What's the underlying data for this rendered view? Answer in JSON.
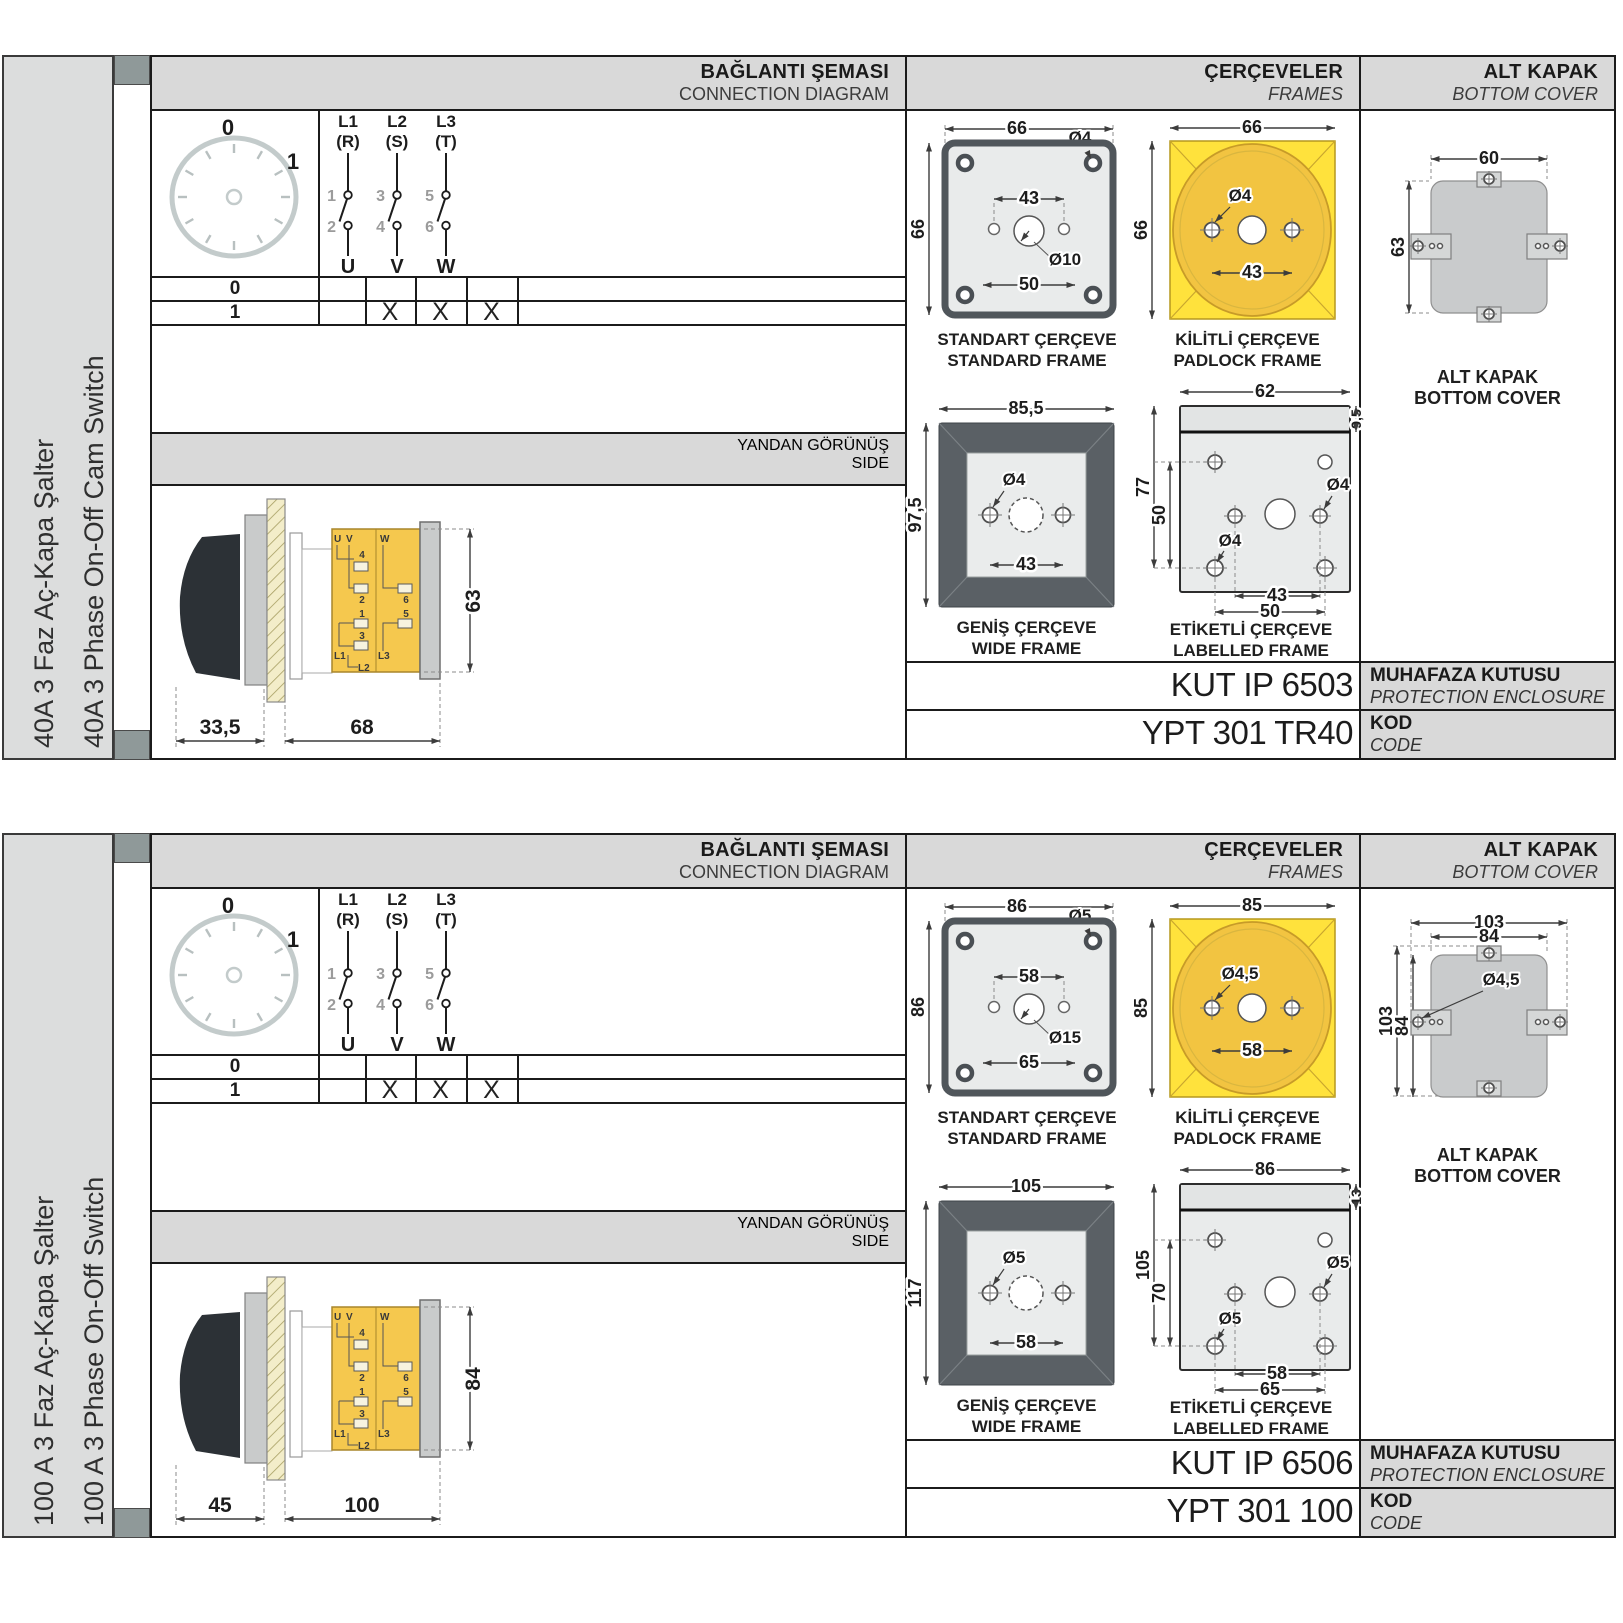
{
  "sections": [
    {
      "sidebar": {
        "label_tr": "40A 3 Faz Aç-Kapa Şalter",
        "label_en": "40A 3 Phase On-Off Cam Switch"
      },
      "headers": {
        "connection_tr": "BAĞLANTI ŞEMASI",
        "connection_en": "CONNECTION DIAGRAM",
        "frames_tr": "ÇERÇEVELER",
        "frames_en": "FRAMES",
        "cover_tr": "ALT KAPAK",
        "cover_en": "BOTTOM COVER",
        "side_tr": "YANDAN GÖRÜNÜŞ",
        "side_en": "SIDE"
      },
      "dial": {
        "pos0": "0",
        "pos1": "1"
      },
      "phases": [
        {
          "name": "L1",
          "alt": "(R)",
          "t1": "1",
          "t2": "2",
          "out": "U"
        },
        {
          "name": "L2",
          "alt": "(S)",
          "t1": "3",
          "t2": "4",
          "out": "V"
        },
        {
          "name": "L3",
          "alt": "(T)",
          "t1": "5",
          "t2": "6",
          "out": "W"
        }
      ],
      "table": {
        "r0": {
          "pos": "0",
          "m1": "",
          "m2": "",
          "m3": ""
        },
        "r1": {
          "pos": "1",
          "m1": "X",
          "m2": "X",
          "m3": "X"
        }
      },
      "side_view": {
        "dim_front": "33,5",
        "dim_body": "68",
        "dim_height": "63",
        "t": {
          "u": "U",
          "v": "V",
          "w": "W",
          "n1": "1",
          "n2": "2",
          "n3": "3",
          "n4": "4",
          "n5": "5",
          "n6": "6",
          "l1": "L1",
          "l2": "L2",
          "l3": "L3"
        }
      },
      "frames": {
        "standard": {
          "title_tr": "STANDART ÇERÇEVE",
          "title_en": "STANDARD FRAME",
          "dim_w": "66",
          "dim_h": "66",
          "dim_holes": "43",
          "dim_outer": "50",
          "dia_corner": "Ø4",
          "dia_center": "Ø10"
        },
        "padlock": {
          "title_tr": "KİLİTLİ ÇERÇEVE",
          "title_en": "PADLOCK FRAME",
          "dim_w": "66",
          "dim_h": "66",
          "dim_holes": "43",
          "dia": "Ø4"
        },
        "wide": {
          "title_tr": "GENİŞ ÇERÇEVE",
          "title_en": "WIDE FRAME",
          "dim_w": "85,5",
          "dim_h": "97,5",
          "dim_holes": "43",
          "dia": "Ø4"
        },
        "labelled": {
          "title_tr": "ETİKETLİ ÇERÇEVE",
          "title_en": "LABELLED FRAME",
          "dim_w": "62",
          "dim_strip": "9,5",
          "dim_h": "77",
          "dim_holes_v": "50",
          "dim_holes": "43",
          "dim_outer": "50",
          "dia1": "Ø4",
          "dia2": "Ø4"
        }
      },
      "cover": {
        "title_tr": "ALT KAPAK",
        "title_en": "BOTTOM COVER",
        "dim_w": "60",
        "dim_h": "63"
      },
      "enclosure": {
        "value": "KUT IP 6503",
        "label_tr": "MUHAFAZA KUTUSU",
        "label_en": "PROTECTION ENCLOSURE"
      },
      "kod": {
        "value": "YPT 301 TR40",
        "label_tr": "KOD",
        "label_en": "CODE"
      }
    },
    {
      "sidebar": {
        "label_tr": "100 A 3 Faz Aç-Kapa Şalter",
        "label_en": "100 A 3 Phase On-Off Switch"
      },
      "headers": {
        "connection_tr": "BAĞLANTI ŞEMASI",
        "connection_en": "CONNECTION DIAGRAM",
        "frames_tr": "ÇERÇEVELER",
        "frames_en": "FRAMES",
        "cover_tr": "ALT KAPAK",
        "cover_en": "BOTTOM COVER",
        "side_tr": "YANDAN GÖRÜNÜŞ",
        "side_en": "SIDE"
      },
      "dial": {
        "pos0": "0",
        "pos1": "1"
      },
      "phases": [
        {
          "name": "L1",
          "alt": "(R)",
          "t1": "1",
          "t2": "2",
          "out": "U"
        },
        {
          "name": "L2",
          "alt": "(S)",
          "t1": "3",
          "t2": "4",
          "out": "V"
        },
        {
          "name": "L3",
          "alt": "(T)",
          "t1": "5",
          "t2": "6",
          "out": "W"
        }
      ],
      "table": {
        "r0": {
          "pos": "0",
          "m1": "",
          "m2": "",
          "m3": ""
        },
        "r1": {
          "pos": "1",
          "m1": "X",
          "m2": "X",
          "m3": "X"
        }
      },
      "side_view": {
        "dim_front": "45",
        "dim_body": "100",
        "dim_height": "84",
        "t": {
          "u": "U",
          "v": "V",
          "w": "W",
          "n1": "1",
          "n2": "2",
          "n3": "3",
          "n4": "4",
          "n5": "5",
          "n6": "6",
          "l1": "L1",
          "l2": "L2",
          "l3": "L3"
        }
      },
      "frames": {
        "standard": {
          "title_tr": "STANDART ÇERÇEVE",
          "title_en": "STANDARD FRAME",
          "dim_w": "86",
          "dim_h": "86",
          "dim_holes": "58",
          "dim_outer": "65",
          "dia_corner": "Ø5",
          "dia_center": "Ø15"
        },
        "padlock": {
          "title_tr": "KİLİTLİ ÇERÇEVE",
          "title_en": "PADLOCK FRAME",
          "dim_w": "85",
          "dim_h": "85",
          "dim_holes": "58",
          "dia": "Ø4,5"
        },
        "wide": {
          "title_tr": "GENİŞ ÇERÇEVE",
          "title_en": "WIDE FRAME",
          "dim_w": "105",
          "dim_h": "117",
          "dim_holes": "58",
          "dia": "Ø5"
        },
        "labelled": {
          "title_tr": "ETİKETLİ ÇERÇEVE",
          "title_en": "LABELLED FRAME",
          "dim_w": "86",
          "dim_strip": "13",
          "dim_h": "105",
          "dim_holes_v": "70",
          "dim_holes": "58",
          "dim_outer": "65",
          "dia1": "Ø5",
          "dia2": "Ø5"
        }
      },
      "cover": {
        "title_tr": "ALT KAPAK",
        "title_en": "BOTTOM COVER",
        "dim_outer_w": "103",
        "dim_w": "84",
        "dim_outer_h": "103",
        "dim_h": "84",
        "dia": "Ø4,5"
      },
      "enclosure": {
        "value": "KUT IP 6506",
        "label_tr": "MUHAFAZA KUTUSU",
        "label_en": "PROTECTION ENCLOSURE"
      },
      "kod": {
        "value": "YPT 301 100",
        "label_tr": "KOD",
        "label_en": "CODE"
      }
    }
  ]
}
